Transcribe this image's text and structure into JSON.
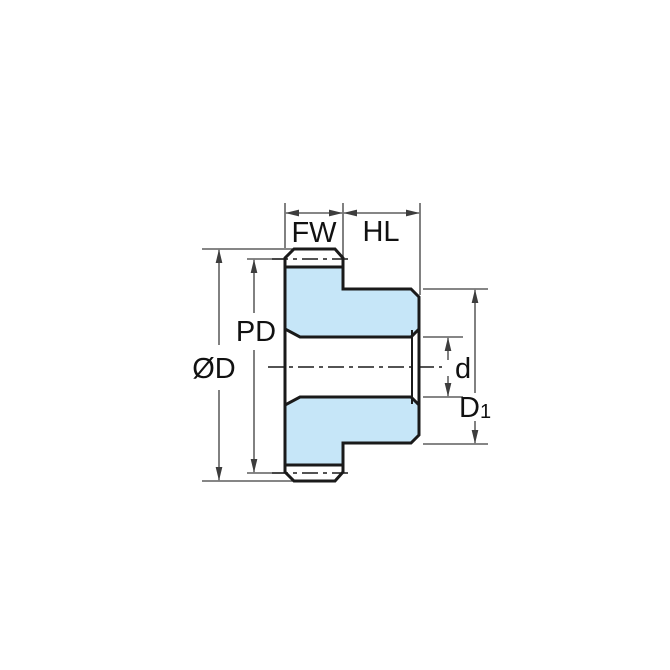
{
  "diagram": {
    "kind": "spur-gear-cross-section-dimension-drawing",
    "labels": {
      "face_width": "FW",
      "hub_length": "HL",
      "pitch_diameter": "PD",
      "outside_diameter": "ØD",
      "bore_diameter": "d",
      "hub_diameter_base": "D",
      "hub_diameter_sub": "1"
    },
    "colors": {
      "part_fill": "#c6e6f8",
      "outline": "#1a1a1a",
      "dimension_line": "#3d3d3d",
      "background": "#ffffff"
    }
  }
}
